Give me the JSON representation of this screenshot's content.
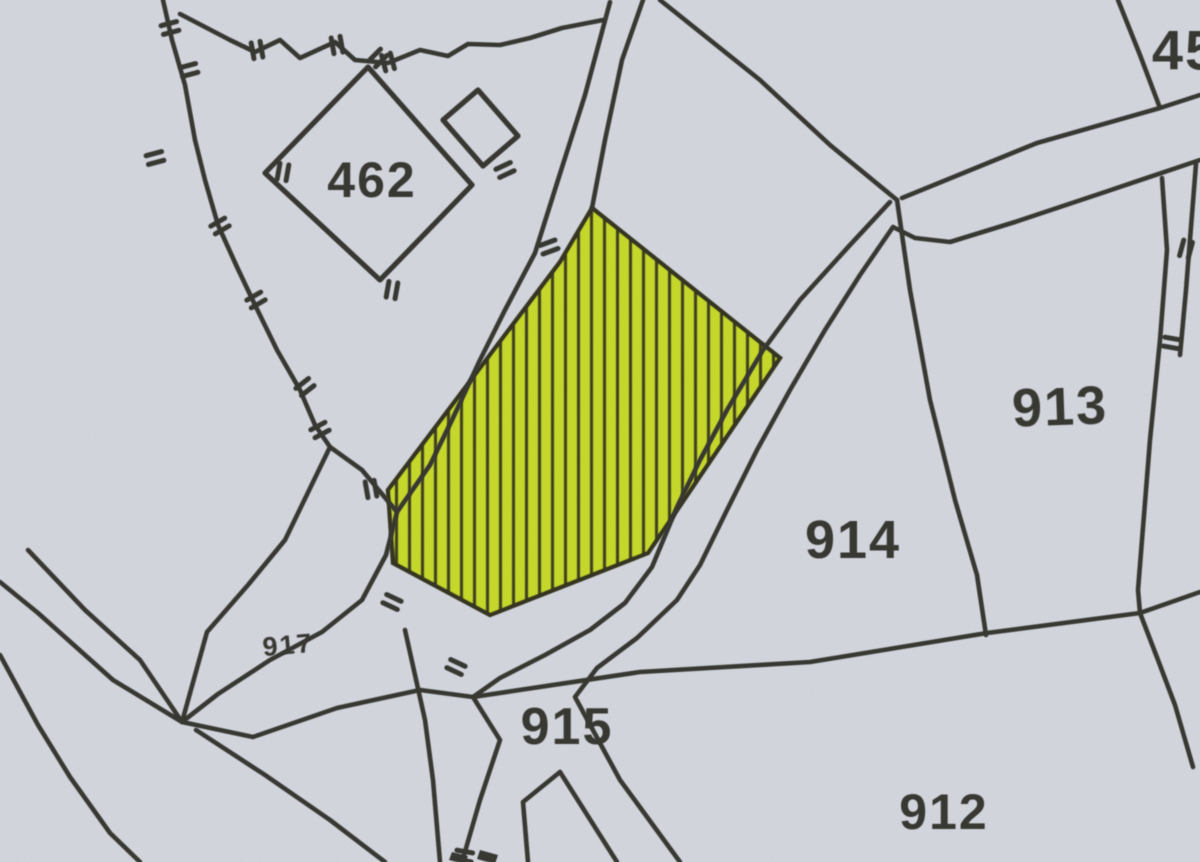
{
  "map": {
    "type_note": "scanned cadastral parcel map with one highlighted parcel",
    "colors": {
      "paper": "#d6d9e0",
      "boundary_line": "#35352f",
      "label_text": "#35352f",
      "highlight_fill": "#c9dc26",
      "hatch_line": "#3c3c1e"
    },
    "labels": {
      "parcel_462": "462",
      "parcel_45_partial": "45",
      "parcel_913": "913",
      "parcel_914": "914",
      "parcel_915": "915",
      "parcel_912": "912",
      "parcel_917": "917"
    }
  }
}
